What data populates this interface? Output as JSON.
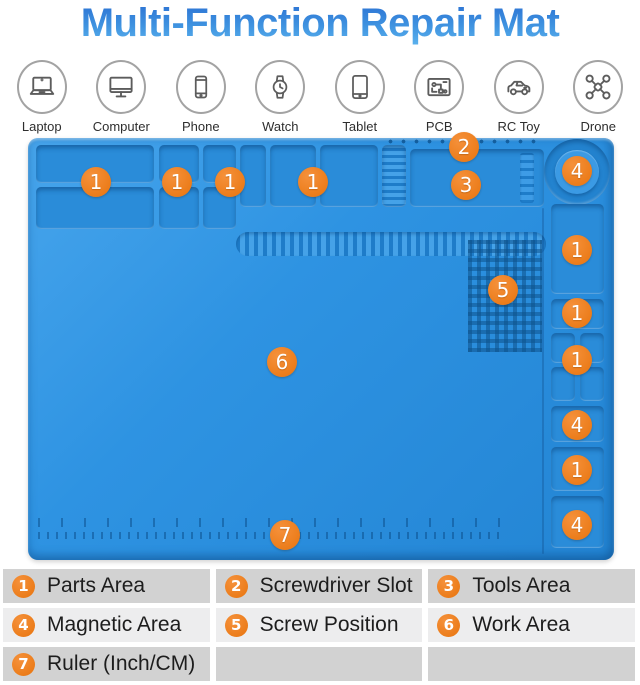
{
  "title": "Multi-Function Repair Mat",
  "devices": [
    {
      "icon": "laptop-icon",
      "label": "Laptop"
    },
    {
      "icon": "computer-icon",
      "label": "Computer"
    },
    {
      "icon": "phone-icon",
      "label": "Phone"
    },
    {
      "icon": "watch-icon",
      "label": "Watch"
    },
    {
      "icon": "tablet-icon",
      "label": "Tablet"
    },
    {
      "icon": "pcb-icon",
      "label": "PCB"
    },
    {
      "icon": "rc-toy-icon",
      "label": "RC Toy"
    },
    {
      "icon": "drone-icon",
      "label": "Drone"
    }
  ],
  "mat": {
    "markers": [
      "1",
      "1",
      "1",
      "1",
      "2",
      "3",
      "4",
      "1",
      "1",
      "1",
      "4",
      "1",
      "4",
      "5",
      "6",
      "7"
    ]
  },
  "legend": {
    "items": [
      {
        "num": "1",
        "label": "Parts Area"
      },
      {
        "num": "2",
        "label": "Screwdriver Slot"
      },
      {
        "num": "3",
        "label": "Tools Area"
      },
      {
        "num": "4",
        "label": "Magnetic Area"
      },
      {
        "num": "5",
        "label": "Screw Position"
      },
      {
        "num": "6",
        "label": "Work Area"
      },
      {
        "num": "7",
        "label": "Ruler (Inch/CM)"
      }
    ]
  },
  "colors": {
    "accent_orange": "#E8740D",
    "mat_blue": "#2E93E2",
    "title_blue_top": "#2A6FD2",
    "title_blue_bottom": "#5CB3EE",
    "legend_row_gray": "#D2D2D2",
    "legend_row_light": "#EDEDEE"
  }
}
